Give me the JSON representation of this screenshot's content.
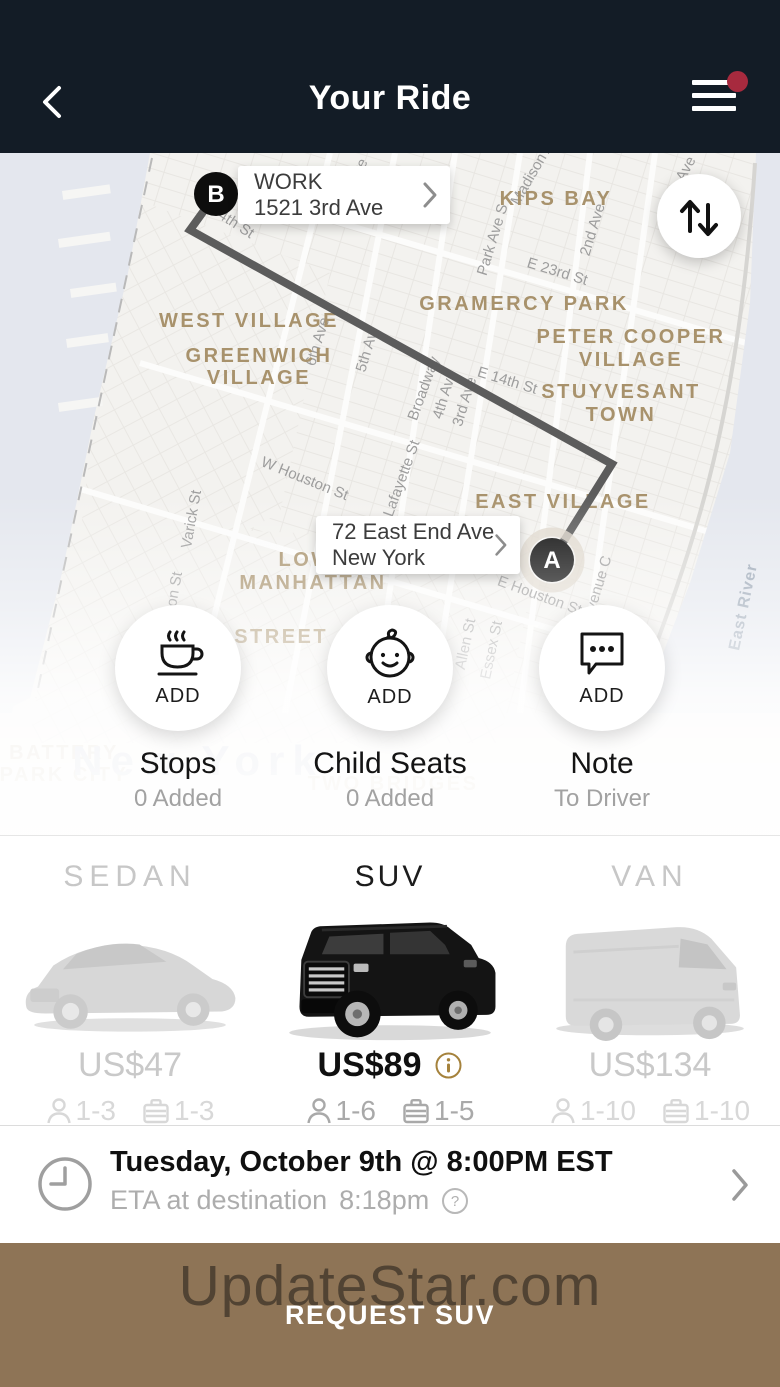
{
  "header": {
    "title": "Your Ride"
  },
  "map": {
    "pin_b": {
      "letter": "B",
      "x": 216,
      "y": 41,
      "label_line1": "WORK",
      "label_line2": "1521 3rd Ave"
    },
    "pin_a": {
      "letter": "A",
      "x": 552,
      "y": 407,
      "label_line1": "72 East End Ave",
      "label_line2": "New York"
    },
    "route": [
      [
        216,
        41
      ],
      [
        190,
        77
      ],
      [
        612,
        311
      ],
      [
        552,
        407
      ]
    ],
    "area_labels": [
      {
        "t": "KIPS BAY",
        "x": 556,
        "y": 52
      },
      {
        "t": "GRAMERCY PARK",
        "x": 524,
        "y": 157
      },
      {
        "t": "PETER COOPER",
        "x": 631,
        "y": 190
      },
      {
        "t": "VILLAGE",
        "x": 631,
        "y": 213
      },
      {
        "t": "WEST VILLAGE",
        "x": 249,
        "y": 174
      },
      {
        "t": "GREENWICH",
        "x": 259,
        "y": 209
      },
      {
        "t": "VILLAGE",
        "x": 259,
        "y": 231
      },
      {
        "t": "STUYVESANT",
        "x": 621,
        "y": 245
      },
      {
        "t": "TOWN",
        "x": 621,
        "y": 268
      },
      {
        "t": "EAST VILLAGE",
        "x": 563,
        "y": 355
      },
      {
        "t": "LOWER",
        "x": 322,
        "y": 413
      },
      {
        "t": "MANHATTAN",
        "x": 313,
        "y": 436
      },
      {
        "t": "NAL STREET",
        "x": 253,
        "y": 490
      },
      {
        "t": "BATTERY",
        "x": 64,
        "y": 606,
        "faded": true
      },
      {
        "t": "PARK CITY",
        "x": 64,
        "y": 628,
        "faded": true
      },
      {
        "t": "TWO BRIDGES",
        "x": 393,
        "y": 637,
        "faded": true
      }
    ],
    "street_labels": [
      {
        "t": "W 4th St",
        "x": 226,
        "y": 70,
        "r": 33
      },
      {
        "t": "Ave",
        "x": 362,
        "y": 20,
        "r": -62
      },
      {
        "t": "Madison Ave",
        "x": 540,
        "y": 16,
        "r": -60
      },
      {
        "t": "Ave",
        "x": 690,
        "y": 18,
        "r": -62
      },
      {
        "t": "Park Ave S",
        "x": 497,
        "y": 88,
        "r": -73
      },
      {
        "t": "2nd Ave",
        "x": 597,
        "y": 78,
        "r": -73
      },
      {
        "t": "E 23rd St",
        "x": 556,
        "y": 123,
        "r": 17
      },
      {
        "t": "E 14th St",
        "x": 506,
        "y": 232,
        "r": 17
      },
      {
        "t": "6th Ave",
        "x": 322,
        "y": 190,
        "r": -73
      },
      {
        "t": "5th Av",
        "x": 371,
        "y": 200,
        "r": -73
      },
      {
        "t": "Broadway",
        "x": 428,
        "y": 237,
        "r": -70
      },
      {
        "t": "4th Ave",
        "x": 449,
        "y": 243,
        "r": -73
      },
      {
        "t": "3rd Ave",
        "x": 469,
        "y": 250,
        "r": -73
      },
      {
        "t": "Lafayette St",
        "x": 406,
        "y": 327,
        "r": -70
      },
      {
        "t": "W Houston St",
        "x": 303,
        "y": 330,
        "r": 22
      },
      {
        "t": "E Houston St",
        "x": 538,
        "y": 447,
        "r": 20
      },
      {
        "t": "Varick St",
        "x": 196,
        "y": 367,
        "r": -80
      },
      {
        "t": "on St",
        "x": 179,
        "y": 437,
        "r": -80
      },
      {
        "t": "Allen St",
        "x": 470,
        "y": 492,
        "r": -78
      },
      {
        "t": "Essex St",
        "x": 496,
        "y": 498,
        "r": -78
      },
      {
        "t": "Avenue C",
        "x": 602,
        "y": 436,
        "r": -73
      }
    ],
    "water_labels": [
      {
        "t": "East River",
        "x": 748,
        "y": 455,
        "r": -78
      }
    ],
    "city_label": {
      "t": "New York",
      "x": 198,
      "y": 622
    }
  },
  "options": [
    {
      "icon": "coffee-cup-icon",
      "action": "ADD",
      "title": "Stops",
      "subtitle": "0 Added"
    },
    {
      "icon": "baby-icon",
      "action": "ADD",
      "title": "Child Seats",
      "subtitle": "0 Added"
    },
    {
      "icon": "chat-bubble-icon",
      "action": "ADD",
      "title": "Note",
      "subtitle": "To Driver"
    }
  ],
  "vehicles": [
    {
      "name": "SEDAN",
      "price": "US$47",
      "passengers": "1-3",
      "luggage": "1-3",
      "selected": false
    },
    {
      "name": "SUV",
      "price": "US$89",
      "passengers": "1-6",
      "luggage": "1-5",
      "selected": true
    },
    {
      "name": "VAN",
      "price": "US$134",
      "passengers": "1-10",
      "luggage": "1-10",
      "selected": false
    }
  ],
  "schedule": {
    "datetime": "Tuesday, October 9th @ 8:00PM EST",
    "eta_label": "ETA at destination",
    "eta_time": "8:18pm"
  },
  "footer": {
    "watermark": "UpdateStar.com",
    "button": "REQUEST SUV"
  },
  "colors": {
    "header_bg": "#131c26",
    "badge_red": "#a72a3e",
    "footer_brown": "#8e7456",
    "info_gold": "#a5823c",
    "map_area_label": "#a8926c",
    "route_gray": "#5c5c5c"
  }
}
